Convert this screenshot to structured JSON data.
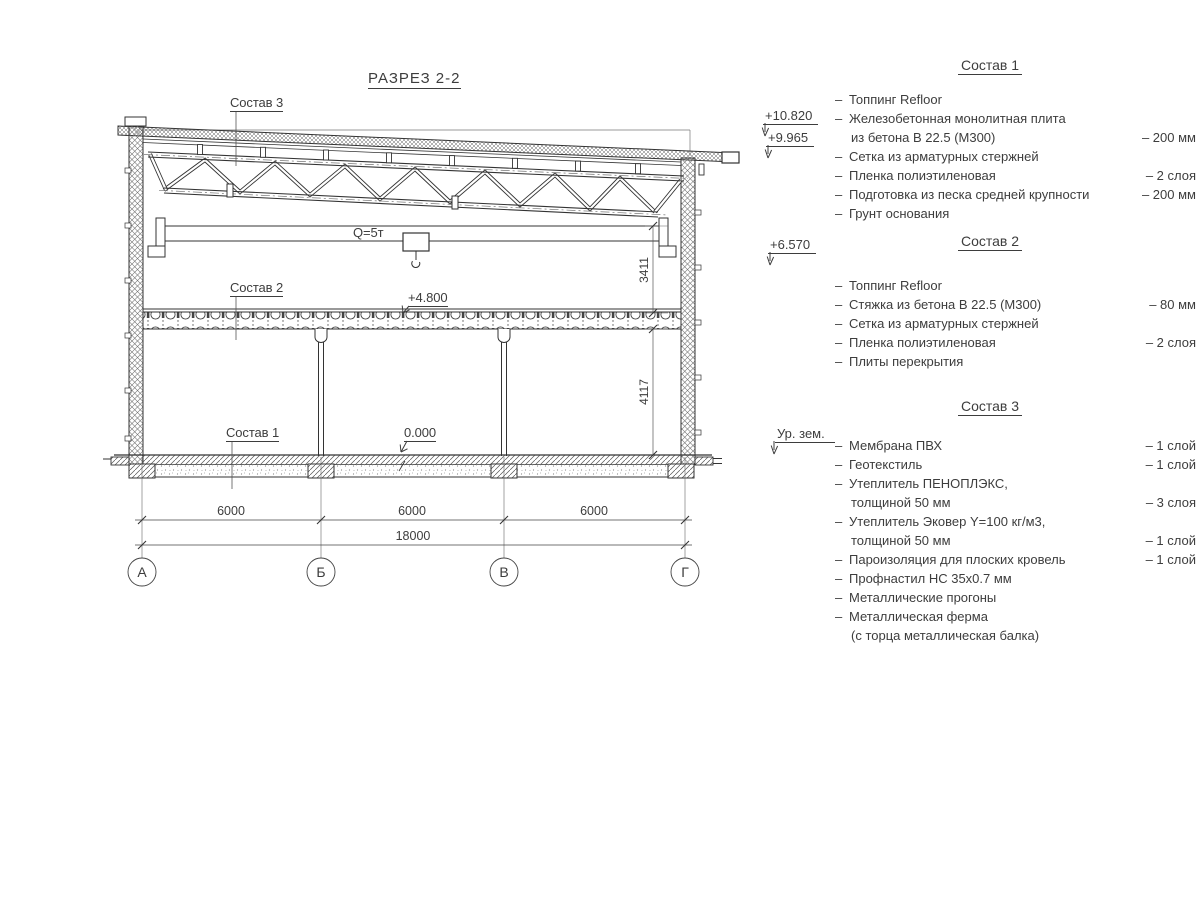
{
  "drawing": {
    "title": "РАЗРЕЗ 2-2",
    "callouts": {
      "c1": "Состав 1",
      "c2": "Состав 2",
      "c3": "Состав 3"
    },
    "crane_label": "Q=5т",
    "elev_marks": {
      "e4800": "+4.800",
      "e0000": "0.000"
    },
    "dims": {
      "v_upper": "3411",
      "v_lower": "4117",
      "spans": [
        "6000",
        "6000",
        "6000"
      ],
      "total": "18000"
    },
    "axes": [
      "А",
      "Б",
      "В",
      "Г"
    ]
  },
  "panel": {
    "elev_marks": [
      {
        "label": "+10.820"
      },
      {
        "label": "+9.965"
      },
      {
        "label": "+6.570"
      },
      {
        "label": "Ур. зем."
      }
    ],
    "sections": [
      {
        "title": "Состав 1",
        "items": [
          {
            "text": "Топпинг Refloor",
            "dash": true,
            "value": ""
          },
          {
            "text": "Железобетонная  монолитная плита",
            "dash": true,
            "value": ""
          },
          {
            "text": "из бетона В 22.5 (М300)",
            "dash": false,
            "value": "– 200 мм"
          },
          {
            "text": "Сетка из арматурных стержней",
            "dash": true,
            "value": ""
          },
          {
            "text": "Пленка полиэтиленовая",
            "dash": true,
            "value": "– 2 слоя"
          },
          {
            "text": "Подготовка из песка средней крупности",
            "dash": true,
            "value": "– 200 мм"
          },
          {
            "text": "Грунт основания",
            "dash": true,
            "value": ""
          }
        ]
      },
      {
        "title": "Состав 2",
        "items": [
          {
            "text": "Топпинг Refloor",
            "dash": true,
            "value": ""
          },
          {
            "text": "Стяжка из бетона В 22.5 (М300)",
            "dash": true,
            "value": "– 80 мм"
          },
          {
            "text": "Сетка из арматурных стержней",
            "dash": true,
            "value": ""
          },
          {
            "text": "Пленка полиэтиленовая",
            "dash": true,
            "value": "– 2 слоя"
          },
          {
            "text": "Плиты перекрытия",
            "dash": true,
            "value": ""
          }
        ]
      },
      {
        "title": "Состав 3",
        "items": [
          {
            "text": "Мембрана ПВХ",
            "dash": true,
            "value": "– 1 слой"
          },
          {
            "text": "Геотекстиль",
            "dash": true,
            "value": "– 1 слой"
          },
          {
            "text": "Утеплитель ПЕНОПЛЭКС,",
            "dash": true,
            "value": ""
          },
          {
            "text": "толщиной 50 мм",
            "dash": false,
            "value": "– 3 слоя"
          },
          {
            "text": "Утеплитель Эковер Y=100 кг/м3,",
            "dash": true,
            "value": ""
          },
          {
            "text": "толщиной 50 мм",
            "dash": false,
            "value": "– 1 слой"
          },
          {
            "text": "Пароизоляция для плоских кровель",
            "dash": true,
            "value": "– 1 слой"
          },
          {
            "text": "Профнастил НС 35х0.7 мм",
            "dash": true,
            "value": ""
          },
          {
            "text": "Металлические прогоны",
            "dash": true,
            "value": ""
          },
          {
            "text": "Металлическая ферма",
            "dash": true,
            "value": ""
          },
          {
            "text": "(с торца металлическая балка)",
            "dash": false,
            "value": ""
          }
        ]
      }
    ]
  },
  "colors": {
    "line": "#333333",
    "text": "#3d3d3d"
  }
}
